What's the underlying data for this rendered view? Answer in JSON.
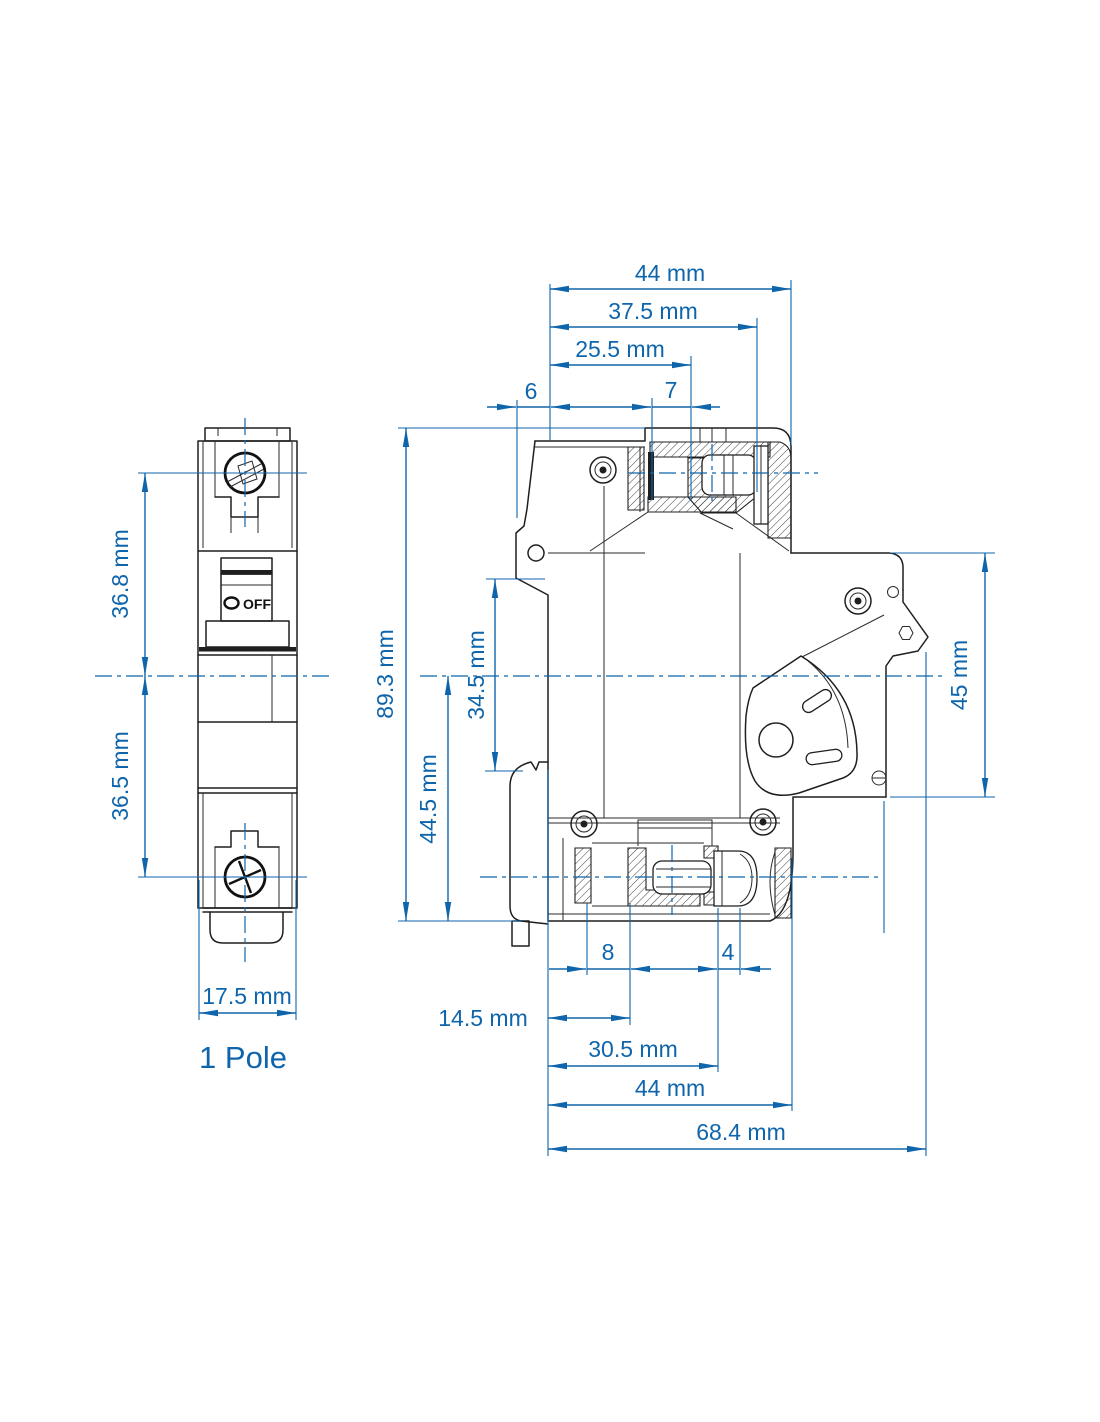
{
  "drawing": {
    "front_view": {
      "pole_label": "1 Pole",
      "toggle_label": "OFF"
    },
    "dimensions": {
      "top_overall": "44 mm",
      "top_37_5": "37.5 mm",
      "top_25_5": "25.5 mm",
      "top_6": "6",
      "top_7": "7",
      "height_overall": "89.3 mm",
      "height_44_5": "44.5 mm",
      "height_34_5": "34.5 mm",
      "right_45": "45 mm",
      "front_36_8": "36.8 mm",
      "front_36_5": "36.5 mm",
      "front_width": "17.5 mm",
      "bottom_8": "8",
      "bottom_4": "4",
      "bottom_14_5": "14.5 mm",
      "bottom_30_5": "30.5 mm",
      "bottom_44": "44 mm",
      "bottom_68_4": "68.4 mm"
    },
    "colors": {
      "annotation_blue": "#0f65ab",
      "line_black": "#1f1f1f",
      "background": "#ffffff"
    }
  }
}
